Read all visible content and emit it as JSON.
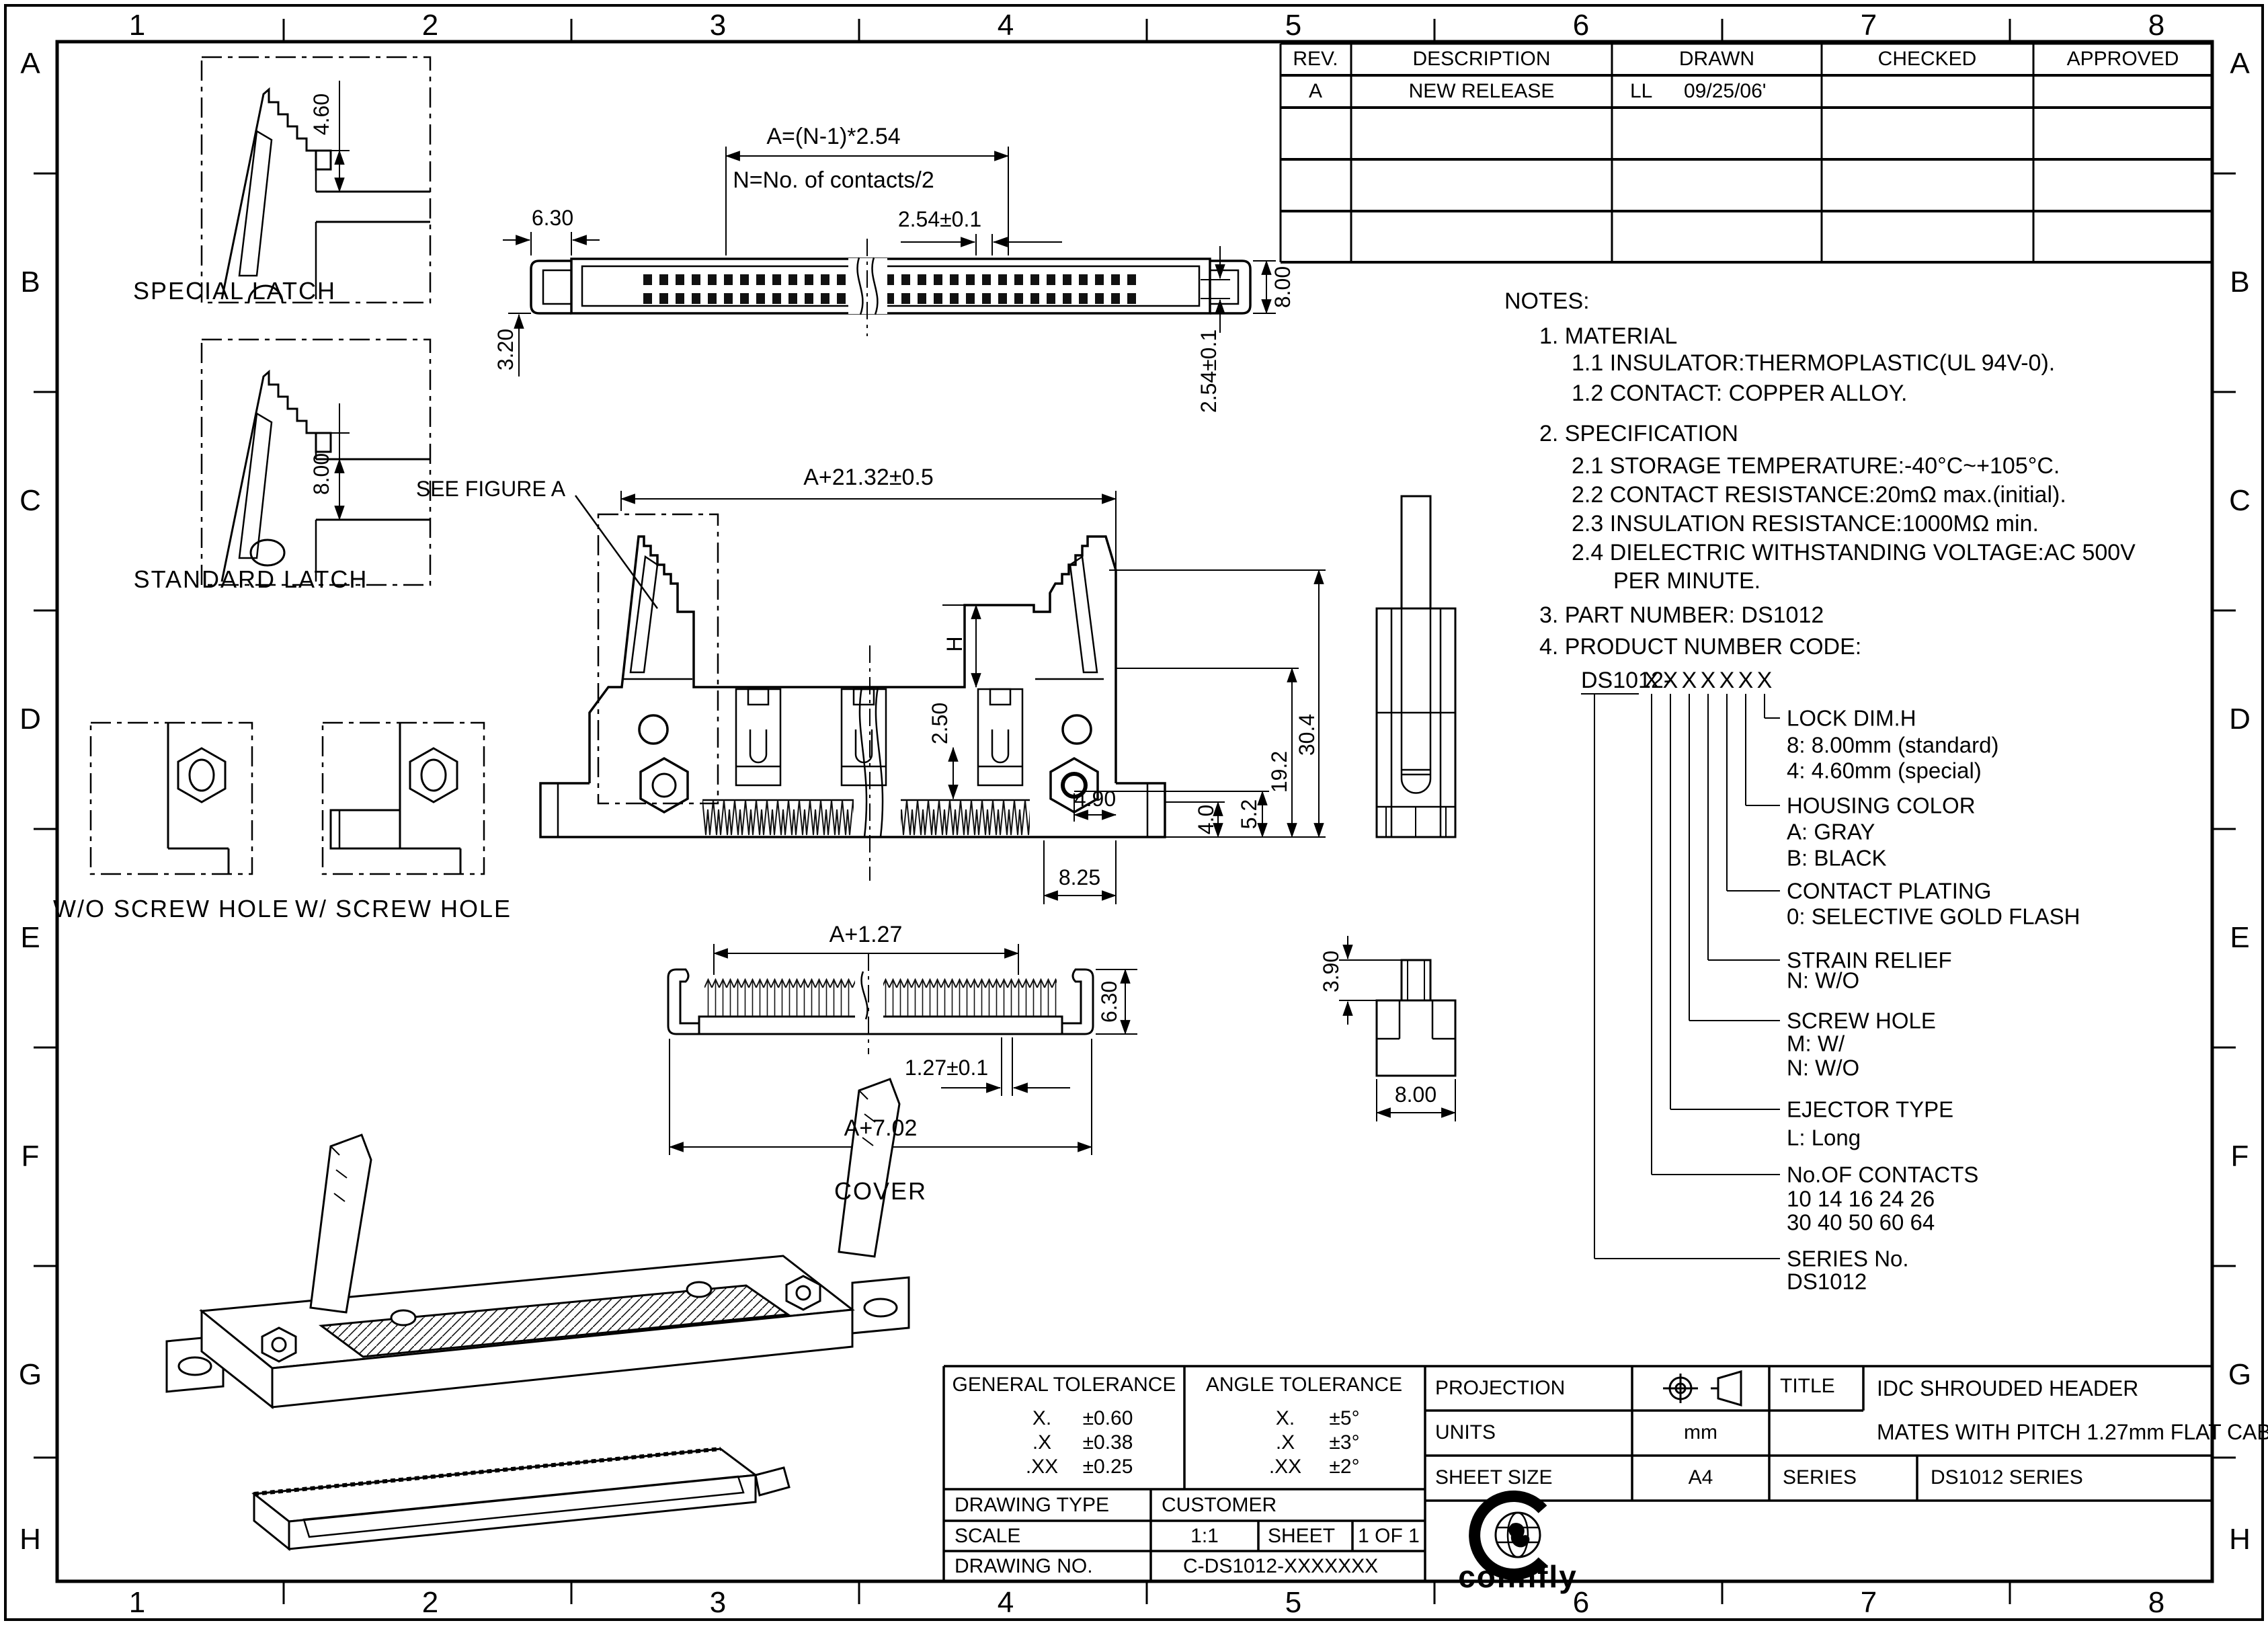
{
  "border": {
    "columns": [
      "1",
      "2",
      "3",
      "4",
      "5",
      "6",
      "7",
      "8"
    ],
    "rows": [
      "A",
      "B",
      "C",
      "D",
      "E",
      "F",
      "G",
      "H"
    ]
  },
  "revision_table": {
    "headers": {
      "rev": "REV.",
      "description": "DESCRIPTION",
      "drawn": "DRAWN",
      "checked": "CHECKED",
      "approved": "APPROVED"
    },
    "row_a": {
      "rev": "A",
      "description": "NEW RELEASE",
      "drawn_by": "LL",
      "drawn_date": "09/25/06'",
      "checked": "",
      "approved": ""
    }
  },
  "latch_details": {
    "special": {
      "label": "SPECIAL LATCH",
      "height": "4.60"
    },
    "standard": {
      "label": "STANDARD LATCH",
      "height": "8.00"
    }
  },
  "top_view": {
    "formula_a": "A=(N-1)*2.54",
    "formula_n": "N=No. of contacts/2",
    "pitch": "2.54±0.1",
    "latch_length": "6.30",
    "latch_offset": "3.20",
    "body_width": "8.00",
    "row_pitch": "2.54±0.1"
  },
  "front_view": {
    "figure_ref": "SEE FIGURE A",
    "overall_width": "A+21.32±0.5",
    "lock_dim": "H",
    "contact_tip": "2.50",
    "hex_to_edge": "4.90",
    "foot_height": "4.0",
    "hex_height": "5.2",
    "shroud_height": "19.2",
    "total_height": "30.4",
    "end_width": "8.25"
  },
  "screw_details": {
    "without": "W/O SCREW HOLE",
    "with": "W/ SCREW HOLE"
  },
  "cover_view": {
    "label": "COVER",
    "inner_width": "A+1.27",
    "pitch": "1.27±0.1",
    "overall_width": "A+7.02",
    "height": "6.30"
  },
  "ejector_detail": {
    "tab_height": "3.90",
    "width": "8.00"
  },
  "notes": {
    "title": "NOTES:",
    "n1": "1.  MATERIAL",
    "n1_1": "1.1  INSULATOR:THERMOPLASTIC(UL 94V-0).",
    "n1_2": "1.2  CONTACT:  COPPER  ALLOY.",
    "n2": "2.  SPECIFICATION",
    "n2_1": "2.1  STORAGE  TEMPERATURE:-40°C~+105°C.",
    "n2_2": "2.2  CONTACT  RESISTANCE:20mΩ  max.(initial).",
    "n2_3": "2.3  INSULATION  RESISTANCE:1000MΩ  min.",
    "n2_4": "2.4  DIELECTRIC  WITHSTANDING  VOLTAGE:AC  500V",
    "n2_4b": "PER  MINUTE.",
    "n3": "3.  PART  NUMBER:  DS1012",
    "n4": "4.  PRODUCT  NUMBER  CODE:"
  },
  "product_code": {
    "prefix": "DS1012-",
    "placeholders": [
      "X",
      "X",
      "X",
      "X",
      "X",
      "X",
      "X"
    ],
    "lock": {
      "title": "LOCK  DIM.H",
      "opt1": "8:  8.00mm  (standard)",
      "opt2": "4:  4.60mm  (special)"
    },
    "housing": {
      "title": "HOUSING  COLOR",
      "opt1": "A:  GRAY",
      "opt2": "B:  BLACK"
    },
    "plating": {
      "title": "CONTACT  PLATING",
      "opt1": "0:  SELECTIVE  GOLD  FLASH"
    },
    "strain": {
      "title": "STRAIN  RELIEF",
      "opt1": "N:  W/O"
    },
    "screw": {
      "title": "SCREW  HOLE",
      "opt1": "M:  W/",
      "opt2": "N:  W/O"
    },
    "ejector": {
      "title": "EJECTOR  TYPE",
      "opt1": "L:  Long"
    },
    "contacts": {
      "title": "No.OF  CONTACTS",
      "opt1": "10  14  16  24  26",
      "opt2": "30  40  50  60  64"
    },
    "series": {
      "title": "SERIES  No.",
      "opt1": "DS1012"
    }
  },
  "tolerance_block": {
    "general_title": "GENERAL  TOLERANCE",
    "angle_title": "ANGLE  TOLERANCE",
    "g1l": "X.",
    "g1v": "±0.60",
    "g2l": ".X",
    "g2v": "±0.38",
    "g3l": ".XX",
    "g3v": "±0.25",
    "a1l": "X.",
    "a1v": "±5°",
    "a2l": ".X",
    "a2v": "±3°",
    "a3l": ".XX",
    "a3v": "±2°",
    "drawing_type": "DRAWING  TYPE",
    "customer": "CUSTOMER",
    "scale_label": "SCALE",
    "scale_value": "1:1",
    "sheet_label": "SHEET",
    "sheet_value": "1  OF  1",
    "drawing_no_label": "DRAWING  NO.",
    "drawing_no_value": "C-DS1012-XXXXXXX"
  },
  "title_block": {
    "projection_label": "PROJECTION",
    "units_label": "UNITS",
    "units_value": "mm",
    "sheet_size_label": "SHEET  SIZE",
    "sheet_size_value": "A4",
    "title_label": "TITLE",
    "title_line1": "IDC  SHROUDED  HEADER",
    "title_line2": "MATES  WITH  PITCH  1.27mm  FLAT  CABLE",
    "series_label": "SERIES",
    "series_value": "DS1012  SERIES",
    "logo_text": "connfly"
  },
  "colors": {
    "line": "#000000",
    "background": "#ffffff"
  }
}
